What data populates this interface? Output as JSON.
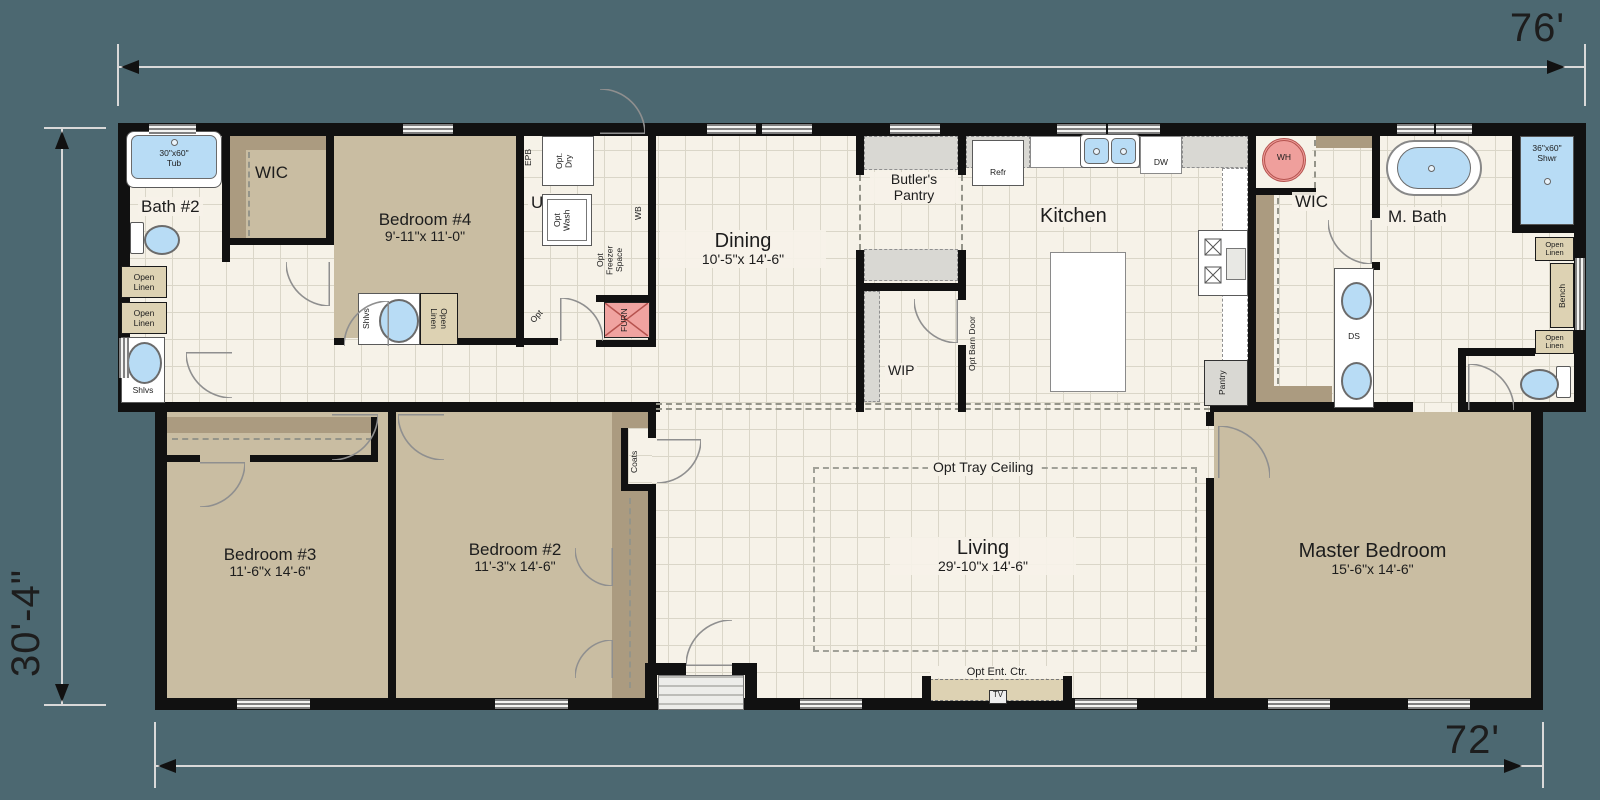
{
  "dimensions": {
    "top": "76'",
    "bottom": "72'",
    "left": "30'-4\""
  },
  "rooms": {
    "bath2": {
      "name": "Bath #2"
    },
    "wic_left": {
      "name": "WIC"
    },
    "bedroom4": {
      "name": "Bedroom #4",
      "dims": "9'-11\"x 11'-0\""
    },
    "utility": {
      "name": "Utility"
    },
    "dining": {
      "name": "Dining",
      "dims": "10'-5\"x 14'-6\""
    },
    "butlers": {
      "line1": "Butler's",
      "line2": "Pantry"
    },
    "kitchen": {
      "name": "Kitchen"
    },
    "wip": {
      "name": "WIP"
    },
    "wic_master": {
      "name": "WIC"
    },
    "mbath": {
      "name": "M. Bath"
    },
    "bedroom3": {
      "name": "Bedroom #3",
      "dims": "11'-6\"x 14'-6\""
    },
    "bedroom2": {
      "name": "Bedroom #2",
      "dims": "11'-3\"x 14'-6\""
    },
    "living": {
      "name": "Living",
      "dims": "29'-10\"x 14'-6\""
    },
    "master": {
      "name": "Master Bedroom",
      "dims": "15'-6\"x 14'-6\""
    }
  },
  "labels": {
    "tub1": "30\"x60\"",
    "tub2": "Tub",
    "shwr1": "36\"x60\"",
    "shwr2": "Shwr",
    "open": "Open",
    "linen": "Linen",
    "shlvs": "Shlvs",
    "epb": "EPB",
    "wb": "WB",
    "dry1": "Opt.",
    "dry2": "Dry",
    "wash1": "Opt",
    "wash2": "Wash",
    "frz1": "Opt",
    "frz2": "Freezer",
    "frz3": "Space",
    "furn": "FURN",
    "opt": "Opt",
    "refr": "Refr",
    "dw": "DW",
    "barn": "Opt Barn Door",
    "pantry": "Pantry",
    "wh": "WH",
    "ds": "DS",
    "bench": "Bench",
    "coats": "Coats",
    "tray": "Opt Tray Ceiling",
    "entctr": "Opt Ent. Ctr.",
    "tv": "TV"
  },
  "colors": {
    "background": "#4c6871",
    "walls": "#111111",
    "carpet_tan": "#c9bda2",
    "closet_tan": "#ab9b80",
    "tile_cream": "#f6f2e8",
    "fixture_blue": "#b8dcf5",
    "water_heater_red": "#ef9f9c",
    "furnace_red": "#f0a3a0",
    "linen_tan": "#ddd2b3",
    "counter_gray": "#d9d8d3"
  }
}
